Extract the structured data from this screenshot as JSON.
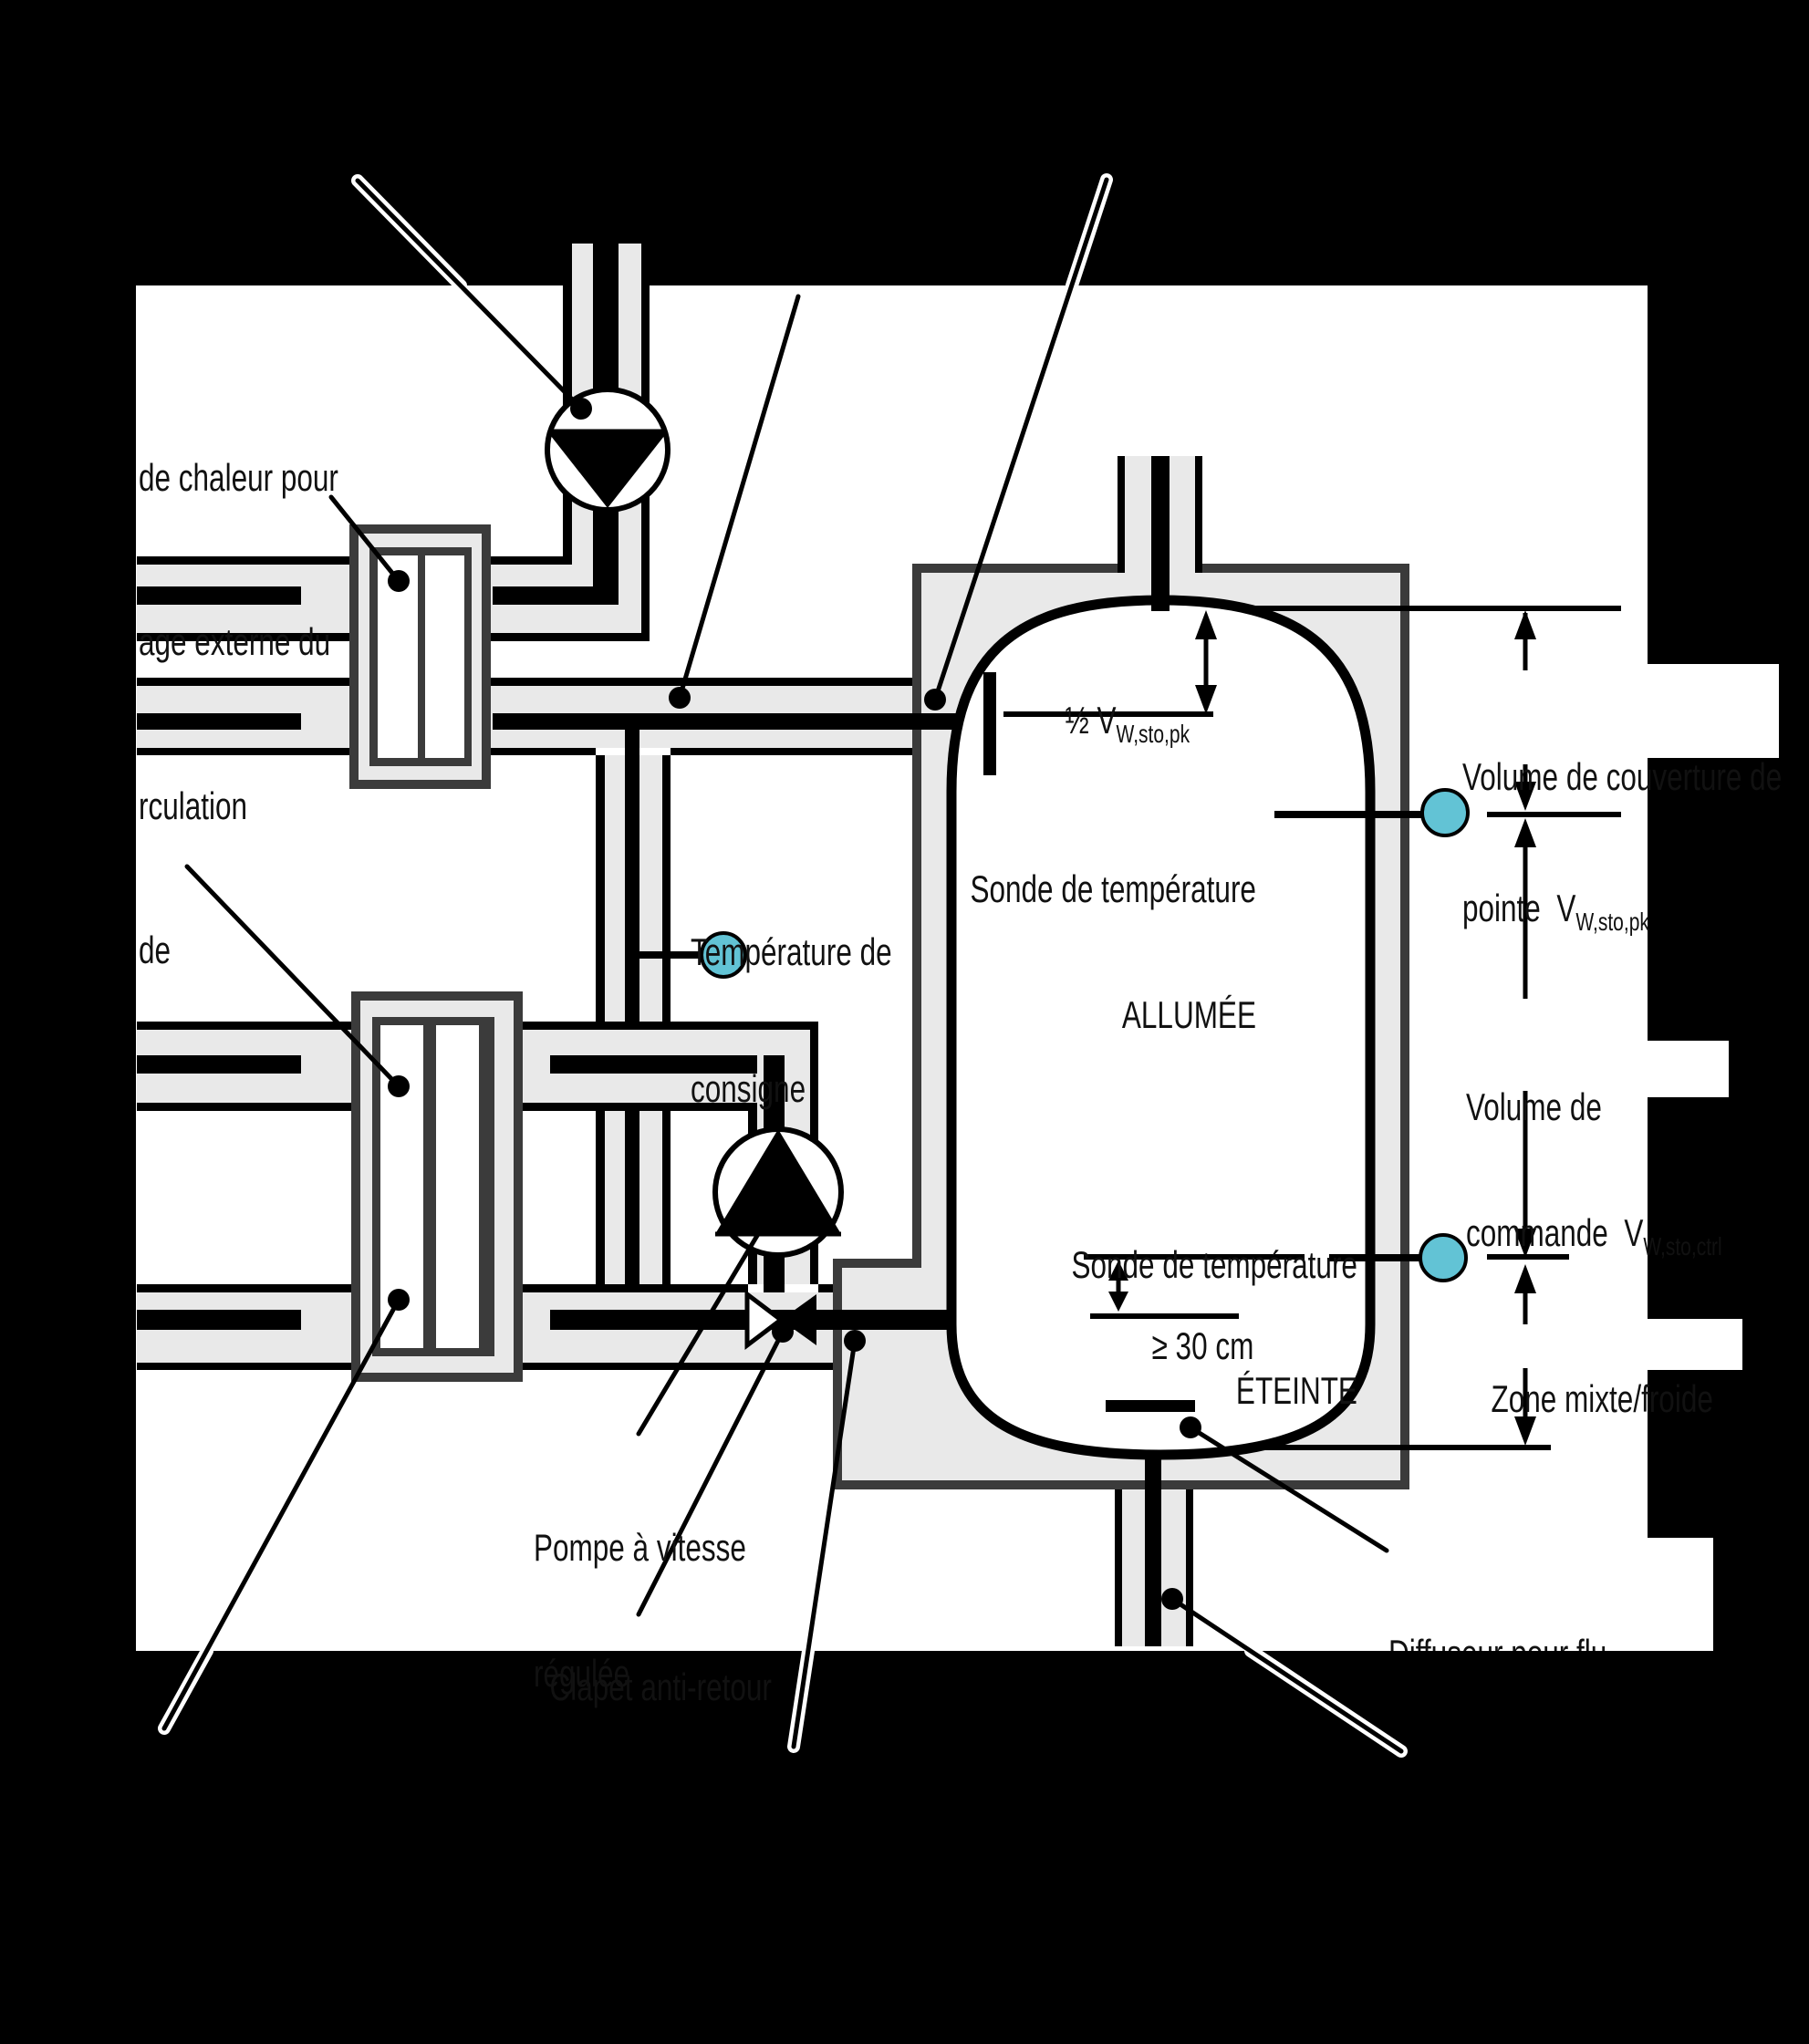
{
  "labels": {
    "hx_top_line1": "de chaleur pour",
    "hx_top_line2": "age externe du",
    "hx_top_line3": "rculation",
    "hx_bottom": "de",
    "setpoint_line1": "Température de",
    "setpoint_line2": "consigne",
    "half_peak_main": "½ V",
    "half_peak_sub": "W,sto,pk",
    "sensor_on_line1": "Sonde de température",
    "sensor_on_line2": "ALLUMÉE",
    "sensor_off_line1": "Sonde de température",
    "sensor_off_line2": "ÉTEINTE",
    "min_distance": "≥ 30 cm",
    "pump_line1": "Pompe à vitesse",
    "pump_line2": "régulée",
    "check_valve": "Clapet anti-retour",
    "peak_cover_line1": "Volume de couverture de",
    "peak_cover_line2": "pointe  V",
    "peak_cover_sub": "W,sto,pk",
    "control_line1": "Volume de",
    "control_line2": "commande  V",
    "control_sub": "W,sto,ctrl",
    "mixed_zone": "Zone mixte/froide",
    "diffuser_line1": "Diffuseur pour flu",
    "diffuser_line2": "entrant à faible",
    "diffuser_line3": "impulsion"
  },
  "colors": {
    "background": "#000000",
    "paper": "#ffffff",
    "pipe_fill": "#e9e9e9",
    "wall": "#3b3b3b",
    "line": "#000000",
    "sensor_fill": "#62c3d5"
  }
}
